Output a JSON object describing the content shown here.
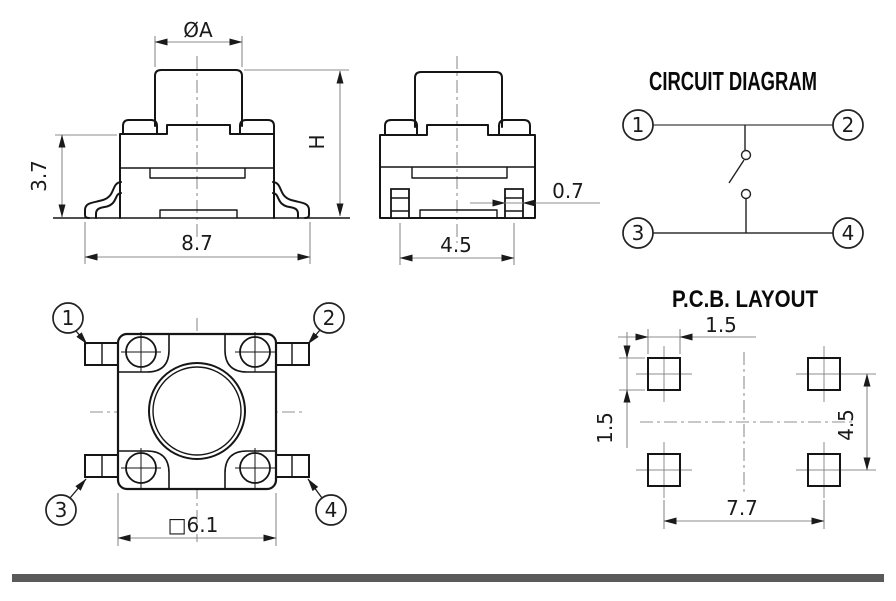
{
  "front_view": {
    "dim_cap_diameter": "ØA",
    "dim_body_height": "3.7",
    "dim_overall_width": "8.7",
    "dim_total_height": "H"
  },
  "side_view": {
    "dim_lead_width": "0.7",
    "dim_lead_pitch": "4.5"
  },
  "top_view": {
    "dim_body_size": "□6.1",
    "pin_labels": [
      "1",
      "2",
      "3",
      "4"
    ]
  },
  "circuit_diagram": {
    "title": "CIRCUIT DIAGRAM",
    "terminal_labels": [
      "1",
      "2",
      "3",
      "4"
    ]
  },
  "pcb_layout": {
    "title": "P.C.B. LAYOUT",
    "dim_pad_width": "1.5",
    "dim_pad_height": "1.5",
    "dim_vertical_pitch": "4.5",
    "dim_horizontal_pitch": "7.7"
  },
  "colors": {
    "outline": "#151515",
    "dimension": "#8c8c8c",
    "text": "#1a1a1a",
    "footer_bar": "#5a5a5a",
    "background": "#ffffff"
  }
}
